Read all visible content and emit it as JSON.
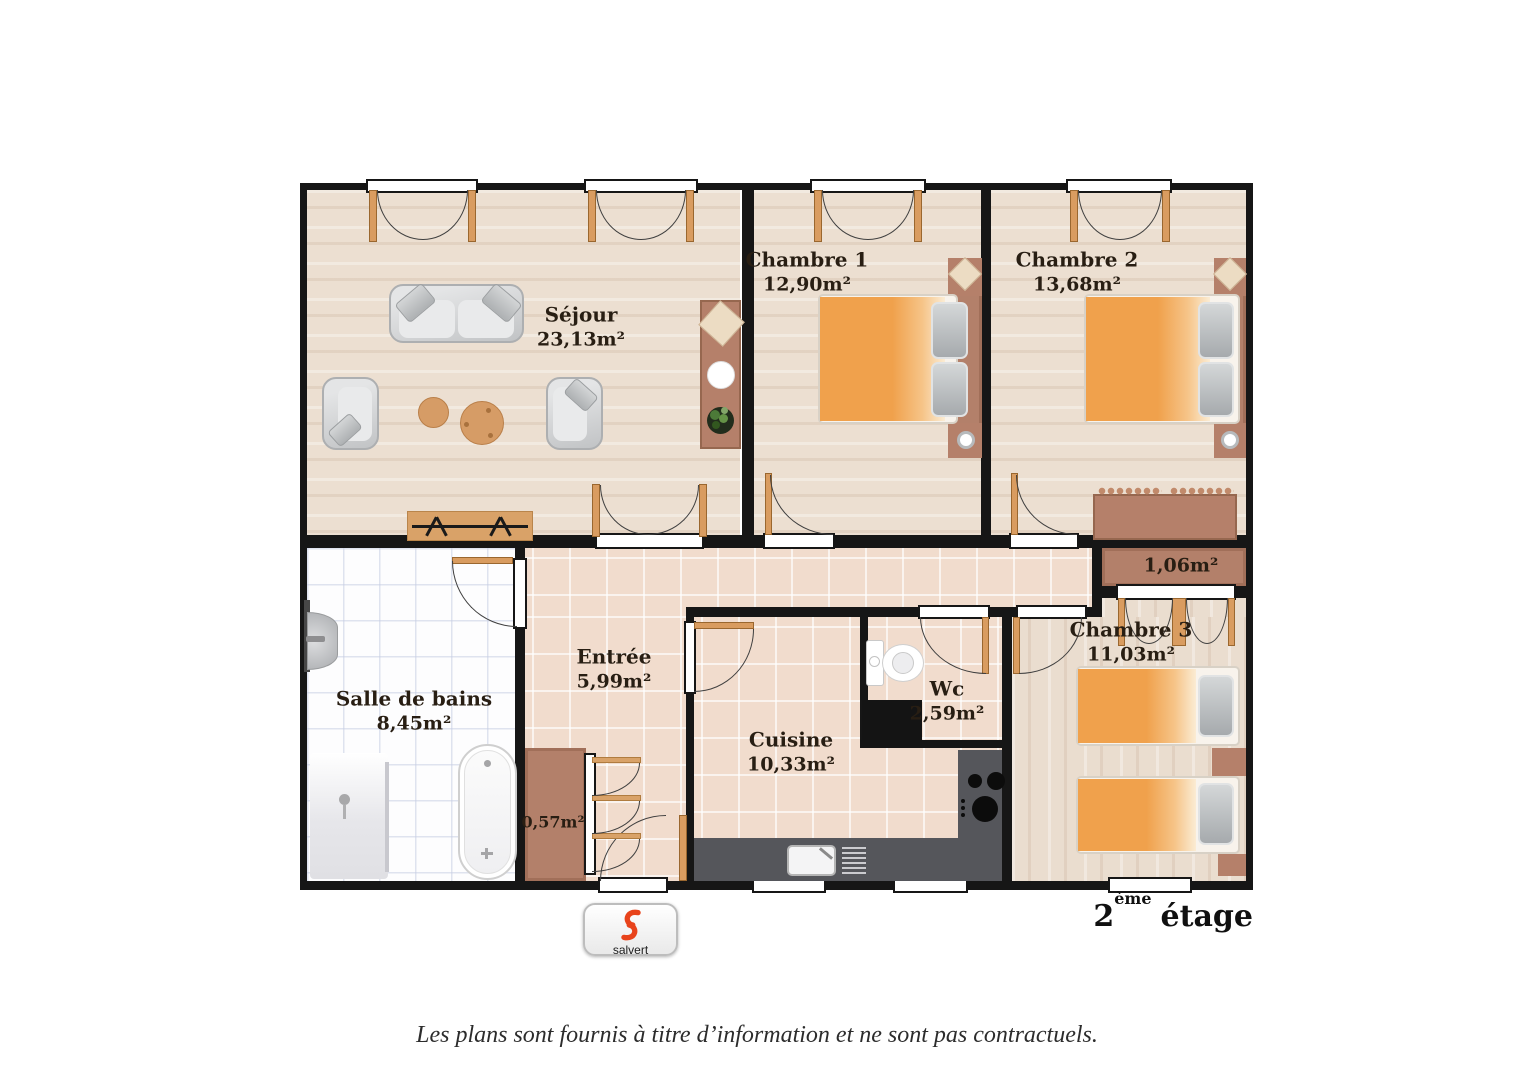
{
  "page": {
    "disclaimer": "Les plans sont fournis à titre d’information et ne sont pas contractuels.",
    "floor": {
      "number": "2",
      "ordinal": "ème",
      "word": "étage"
    },
    "logo": {
      "brand": "salvert"
    }
  },
  "rooms": [
    {
      "name": "Séjour",
      "area": "23,13m²"
    },
    {
      "name": "Chambre 1",
      "area": "12,90m²"
    },
    {
      "name": "Chambre 2",
      "area": "13,68m²"
    },
    {
      "name": "Salle de bains",
      "area": "8,45m²"
    },
    {
      "name": "Entrée",
      "area": "5,99m²"
    },
    {
      "name": "Wc",
      "area": "2,59m²"
    },
    {
      "name": "Cuisine",
      "area": "10,33m²"
    },
    {
      "name": "Chambre 3",
      "area": "11,03m²"
    }
  ],
  "closets": [
    {
      "area": "1,06m²"
    },
    {
      "area": "0,57m²"
    }
  ],
  "colors": {
    "wall": "#161616",
    "wood_floor": "#ecdfd1",
    "tile_floor": "#f1dccd",
    "bath_tile": "#fdfdfe",
    "closet_brown": "#b3806a",
    "bed_orange": "#f0a14c",
    "door_tan": "#d99c60",
    "logo_red": "#e8431b"
  }
}
